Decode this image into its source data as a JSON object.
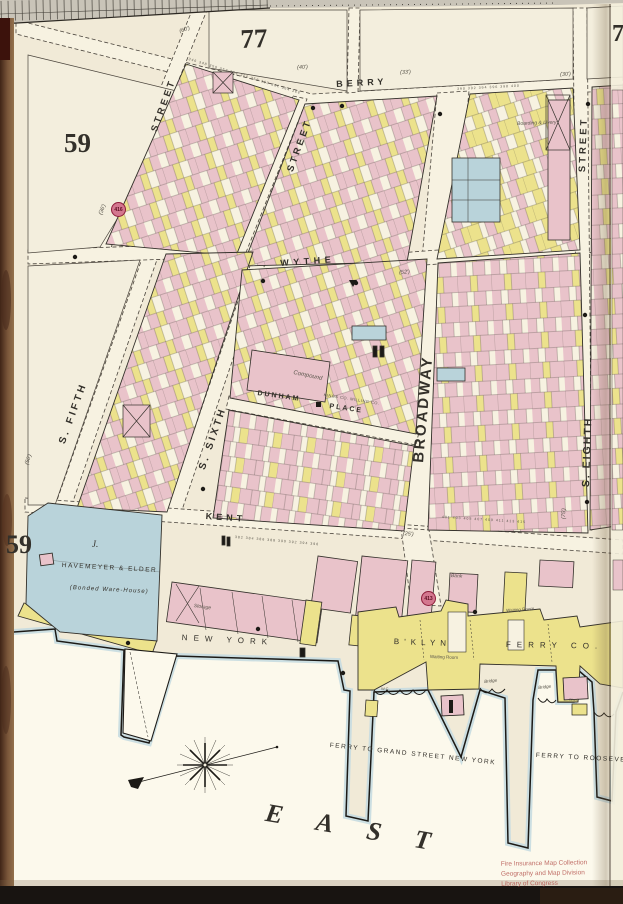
{
  "palette": {
    "page": "#f1ead7",
    "street": "#f7f2e1",
    "water": "#fcf9ec",
    "pink": "#e9c3ca",
    "yellow": "#ece28c",
    "blue": "#b9d3da",
    "fringe": "#c6dbe1",
    "ink": "#33302a",
    "red-circle": "#d4778f",
    "stamp-red": "#b5544e",
    "ruler": "#c9c4b8",
    "book-edge": "#7a563a"
  },
  "sheet": {
    "number": "77",
    "adjacent_number": "7",
    "block_left": "59",
    "block_lower": "59"
  },
  "reference_circles": {
    "upper": "416",
    "lower": "413"
  },
  "streets": {
    "berry": "BERRY",
    "wythe": "WYTHE",
    "kent": "KENT",
    "broadway": "BROADWAY",
    "s_fifth": "S. FIFTH",
    "s_sixth": "S. SIXTH",
    "s_eighth": "S. EIGHTH",
    "dunham": "DUNHAM",
    "place": "PLACE",
    "street_a": "STREET",
    "street_b": "STREET",
    "street_c": "STREET"
  },
  "waterfront": {
    "ferry_co_1": "NEW YORK",
    "ferry_co_2": "B'KLYN",
    "ferry_co_3": "FERRY CO.",
    "ferry_grand": "FERRY TO GRAND STREET NEW YORK",
    "ferry_roosevelt": "FERRY TO ROOSEVELT",
    "river": "EAST"
  },
  "buildings": {
    "havemeyer_key": "J.",
    "havemeyer_name": "HAVEMEYER & ELDER",
    "havemeyer_sub": "(Bonded Ware-House)",
    "kings_milling": "KINGS CO. MILLING CO.",
    "boarding": "Boarding & Livery",
    "compound": "Compound",
    "storage": "Storage",
    "bank": "Bank",
    "waiting_1": "Waiting Room",
    "waiting_2": "Waiting Room",
    "bridge_1": "Bridge",
    "bridge_2": "Bridge",
    "shed": "Shed",
    "wc": "W.C."
  },
  "width_marks": [
    "(60')",
    "(40')",
    "(33')",
    "(30')",
    "(36')",
    "(52')",
    "(50')",
    "(25')",
    "(75')"
  ],
  "number_strips": [
    "346 348 350 352 354 356 358 360 362 364 366",
    "390 392 394 396 398 400",
    "401 403 405 407 409 411 413 415",
    "382 384 386 388 390 392 394 396"
  ],
  "stamp": {
    "line1": "Fire Insurance Map Collection",
    "line2": "Geography and Map Division",
    "line3": "Library of Congress"
  }
}
